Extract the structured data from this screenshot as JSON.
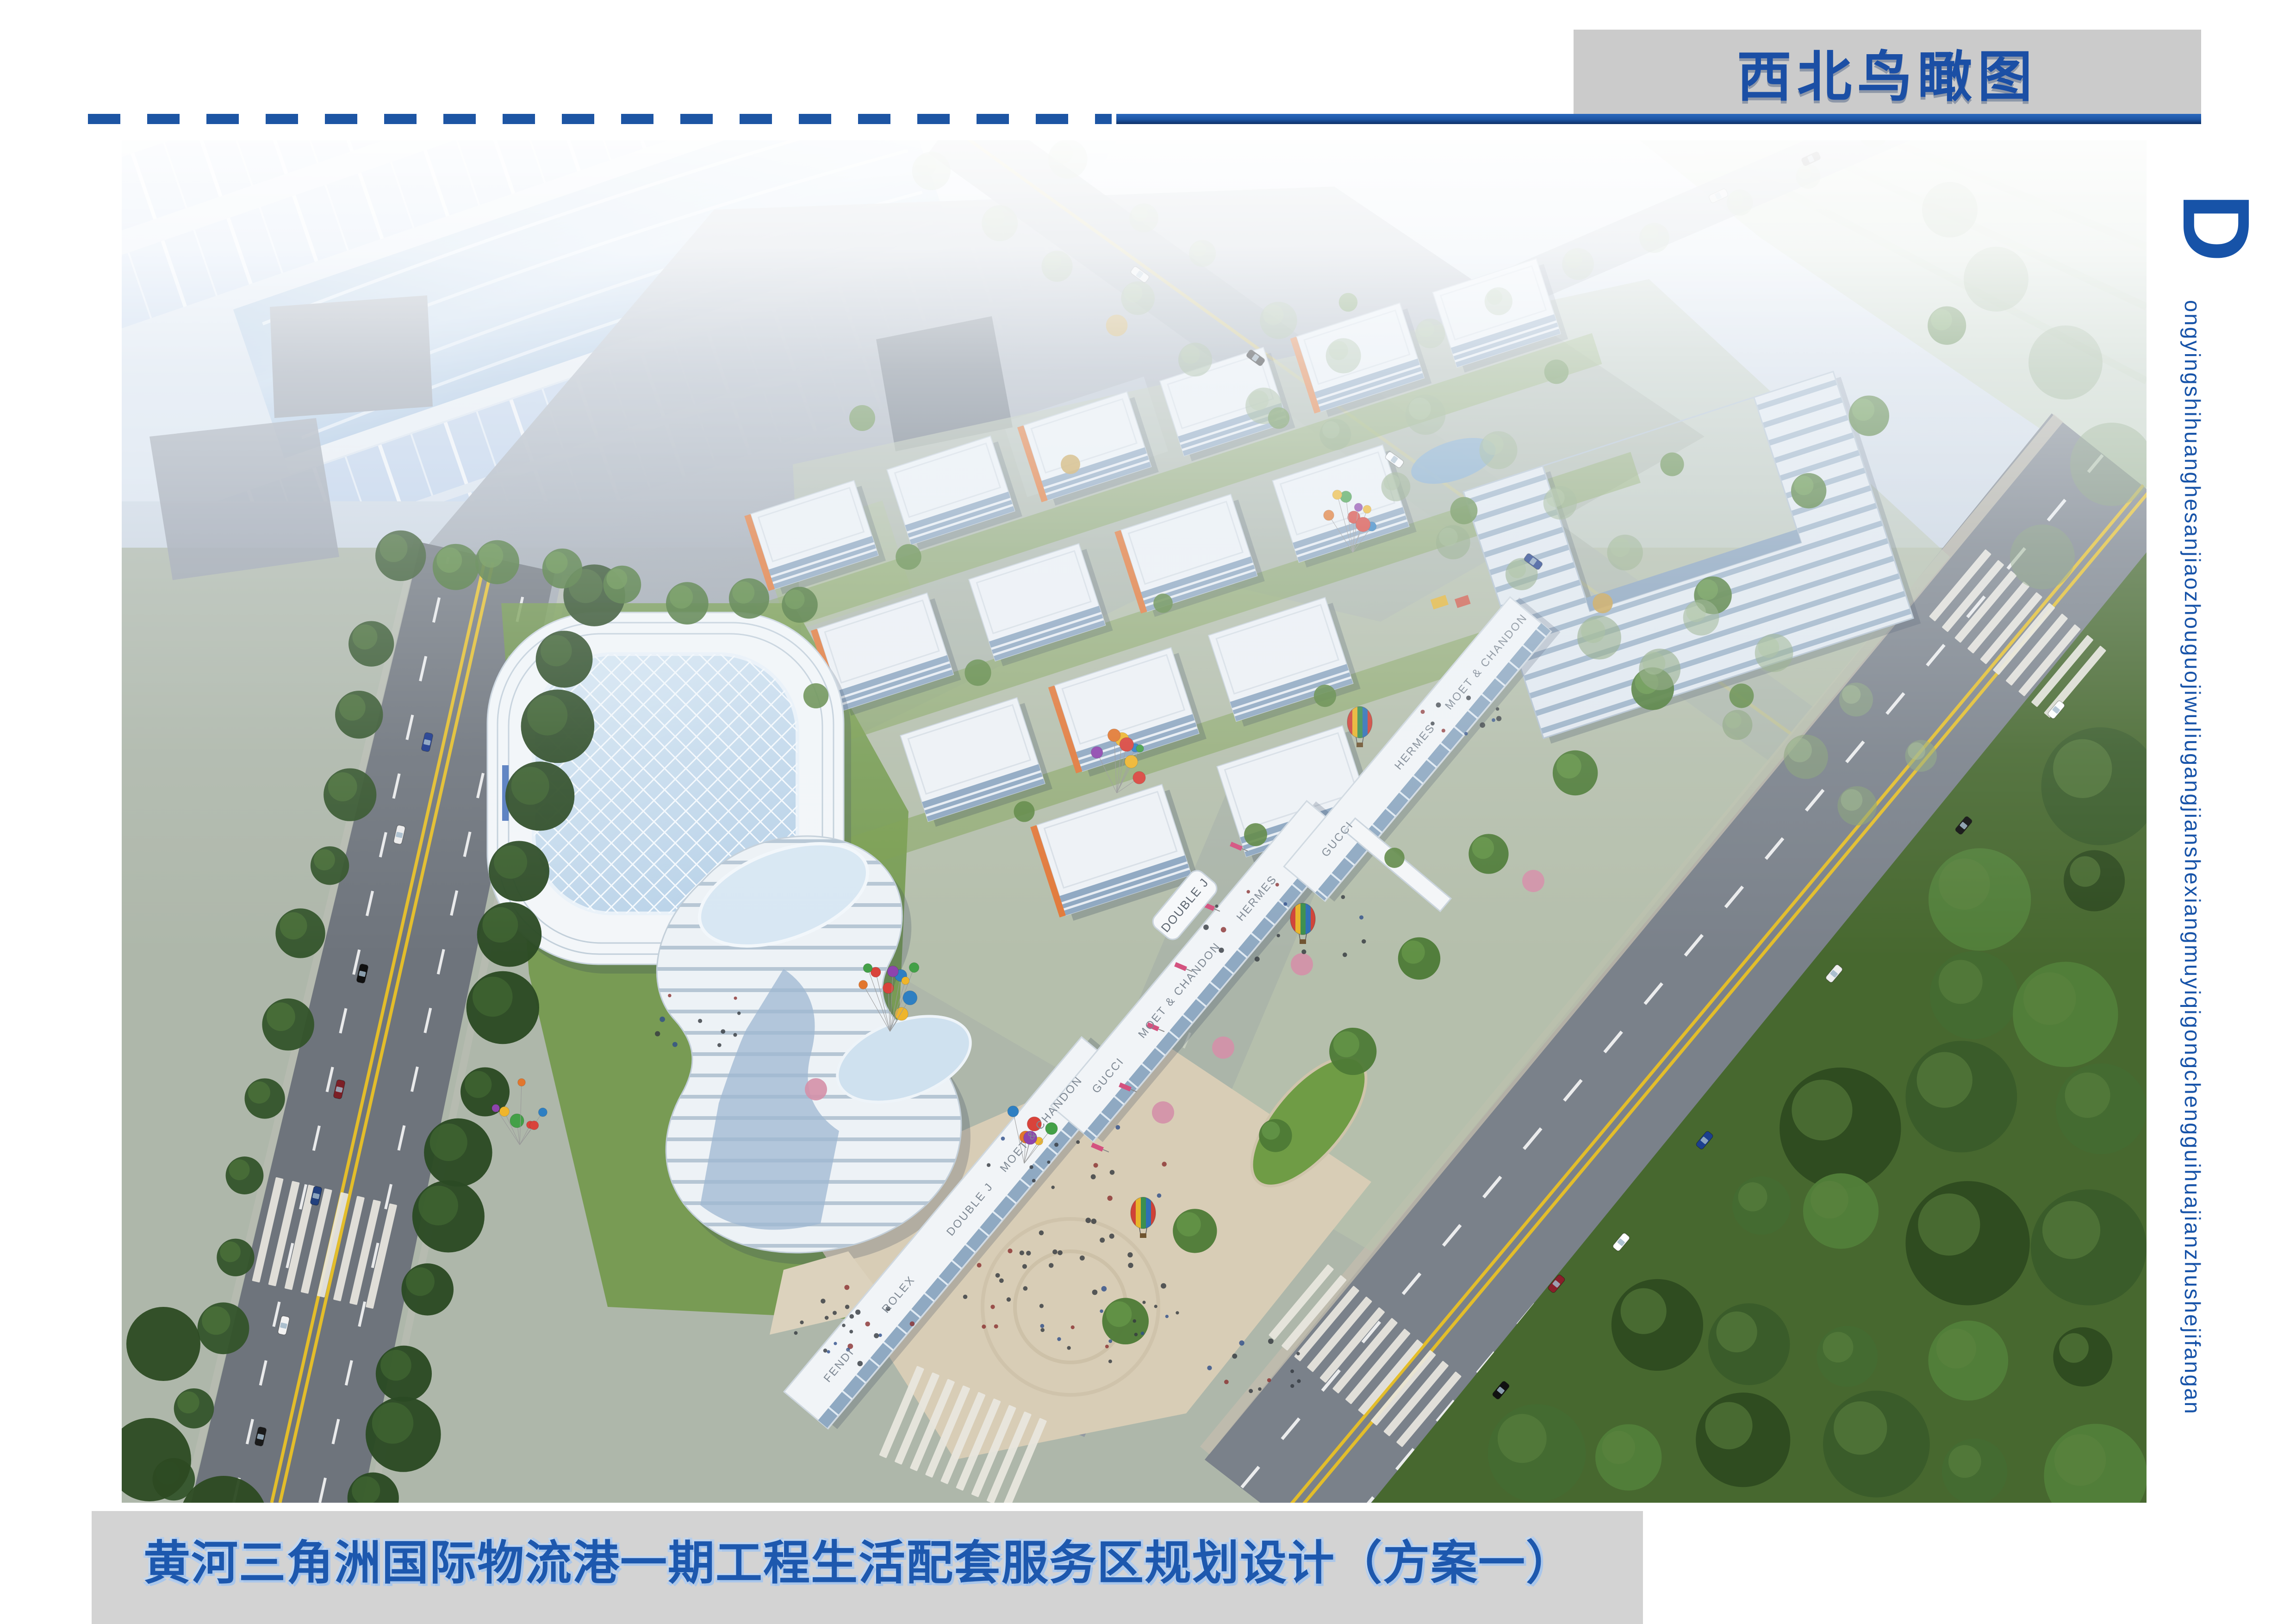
{
  "header": {
    "drawing_title": "西北鸟瞰图",
    "accent_blue": "#1d55a4",
    "box_gray": "#cbcbcb"
  },
  "side_caption": {
    "initial": "D",
    "text": "ongyingshihuanghesanjiaozhouguojiwuliugangjianshexiangmuyiqigongchengguihuajianzhushejifangan"
  },
  "footer": {
    "project_title": "黄河三角洲国际物流港一期工程生活配套服务区规划设计（方案一）",
    "bar_gray": "#d3d3d3"
  },
  "rendering": {
    "description": "Northwest aerial bird's-eye rendering of the logistics port phase-one living service area",
    "signage": [
      "MOET & CHANDON",
      "GUCCI",
      "HERMES",
      "ROLEX",
      "FENDI",
      "DOUBLE J"
    ]
  }
}
